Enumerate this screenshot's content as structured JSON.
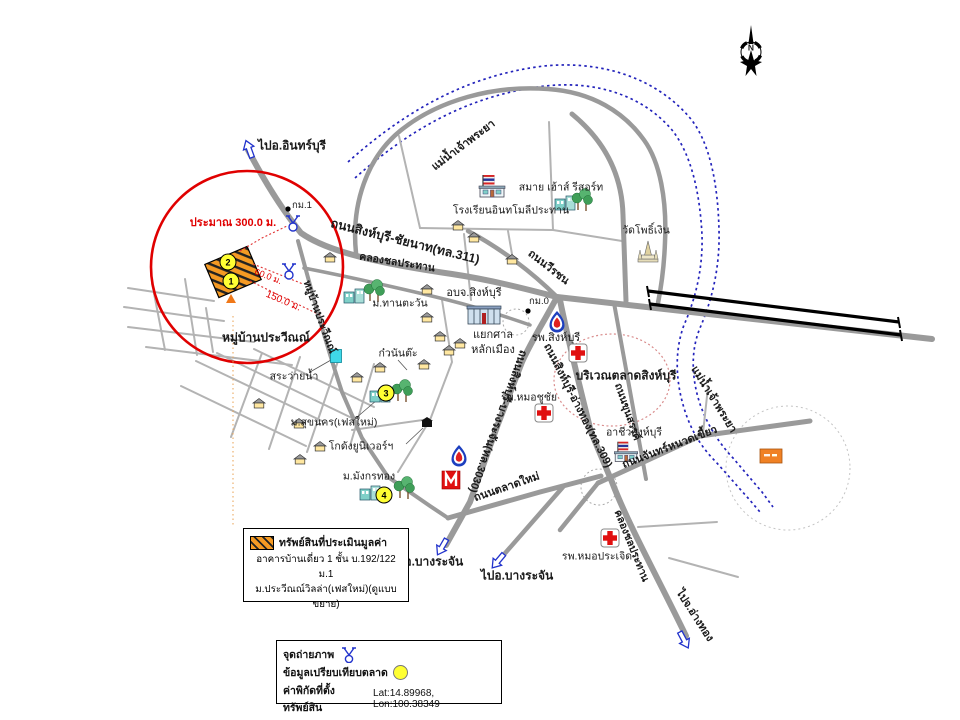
{
  "compass": {
    "north": "N"
  },
  "rivers": {
    "chao_phraya_upper": "แม่น้ำเจ้าพระยา",
    "chao_phraya_lower": "แม่น้ำเจ้าพระยา"
  },
  "roads": {
    "r311": "ถนนสิงห์บุรี-ชัยนาท(ทล.311)",
    "r3030": "ถนนสิงห์บุรี-บางระจัน(ทล.3030)",
    "r309": "ถนนสิงห์บุรี-อ่างทอง(ทล.309)",
    "weerachon": "ถนนวีรชน",
    "khunsan": "ถนนขุนสรรค์",
    "chan_nuad_kiew": "ถนนจันทร์หนวดเขี้ยว",
    "talad_mai": "ถนนตลาดใหม่",
    "canal_upper": "คลองชลประทาน",
    "canal_lower": "คลองชลประทาน",
    "soi_village": "หมู่บ้านประวีณณ์"
  },
  "directions": {
    "to_inburi": "ไปอ.อินทร์บุรี",
    "to_bangrajan_1": "ไปอ.บางระจัน",
    "to_bangrajan_2": "ไปอ.บางระจัน",
    "to_angthong": "ไปจ.อ่างทอง"
  },
  "places": {
    "village_area": "หมู่บ้านประวีณณ์",
    "pool": "สระว่ายน้ำ",
    "suk_nakhon": "ม.สุขนคร(เฟสใหม่)",
    "kuay_nunta": "ก๋วนันต๊ะ",
    "warehouse": "โกดังยูนิเวอร์ฯ",
    "mangkorn_thong": "ม.มังกรทอง",
    "tantawan": "ม.ทานตะวัน",
    "obj_singburi": "อบจ.สิงห์บุรี",
    "yaek_line1": "แยกศาล",
    "yaek_line2": "หลักเมือง",
    "school_inthamoli": "โรงเรียนอินทโมลีประทาน",
    "smile_house": "สมาย เฮ้าส์ รีสอร์ท",
    "wat_pho_ngern": "วัดโพธิ์เงิน",
    "singburi_hospital": "รพ.สิงห์บุรี",
    "market_area": "บริเวณตลาดสิงห์บุรี",
    "chuchai_hospital": "รพ.หมอชูชัย",
    "prajerd_hospital": "รพ.หมอประเจิด",
    "archeewa": "อาชีวสิงห์บุรี"
  },
  "markers": {
    "km1": "กม.1",
    "km0": "กม.0",
    "point1": "1",
    "point2": "2",
    "point3": "3",
    "point4": "4"
  },
  "measurements": {
    "approx_300": "ประมาณ 300.0 ม.",
    "m60": "60.0 ม.",
    "m150": "150.0 ม."
  },
  "legend_property": {
    "title": "ทรัพย์สินที่ประเมินมูลค่า",
    "line1": "อาคารบ้านเดี่ยว 1 ชั้น บ.192/122 ม.1",
    "line2": "ม.ประวีณณ์วิลล่า(เฟสใหม่)(ดูแบบขยาย)"
  },
  "legend_symbols": {
    "photo_point": "จุดถ่ายภาพ",
    "market_comparison": "ข้อมูลเปรียบเทียบตลาด",
    "coordinates_label": "ค่าพิกัดที่ตั้งทรัพย์สิน",
    "coordinates_value": "Lat:14.89968, Lon:100.38349"
  },
  "colors": {
    "highlight_red": "#e00000",
    "river_blue": "#2323bb",
    "property_orange": "#f59a23",
    "marker_yellow": "#ffff33",
    "road_grey": "#9a9a9a"
  }
}
